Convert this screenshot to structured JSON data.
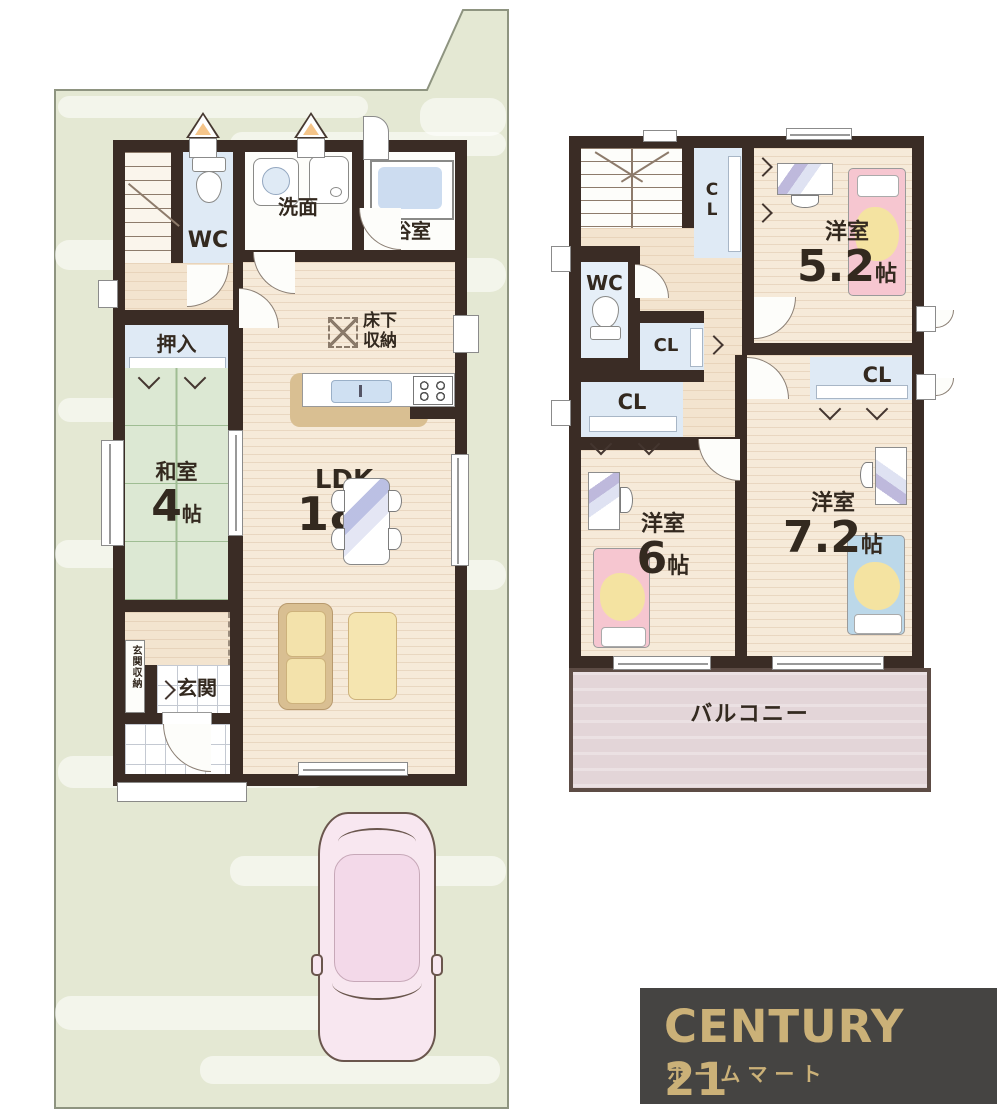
{
  "colors": {
    "wall": "#3a2c25",
    "site_green": "#e4e8d3",
    "wood_floor": "#f6ead9",
    "tatami_green": "#dce8d3",
    "closet_blue": "#dfeaf5",
    "balcony_pink": "#e3d5d8",
    "logo_background": "#454442",
    "logo_gold": "#cbb178",
    "bed_pink": "#f6c6d0",
    "bed_blue": "#bcd8e9",
    "blanket_yellow": "#f4e3a1",
    "sofa_tan": "#d9bf92",
    "car_pink": "#f8e7f0"
  },
  "floor1": {
    "labels": {
      "wc": "WC",
      "washroom": "洗面",
      "bathroom": "浴室",
      "underfloor_storage": "床下収納",
      "closet": "押入",
      "tatami_room": "和室",
      "tatami_size": "4",
      "ldk": "LDK",
      "ldk_size": "18",
      "size_unit": "帖",
      "entrance_storage": "玄関収納",
      "entrance": "玄関"
    }
  },
  "floor2": {
    "labels": {
      "wc": "WC",
      "closet": "CL",
      "western_room": "洋室",
      "room_a_size": "5.2",
      "room_b_size": "6",
      "room_c_size": "7.2",
      "size_unit": "帖",
      "balcony": "バルコニー"
    }
  },
  "branding": {
    "brand": "CENTURY 21",
    "store": "ホームマート"
  }
}
